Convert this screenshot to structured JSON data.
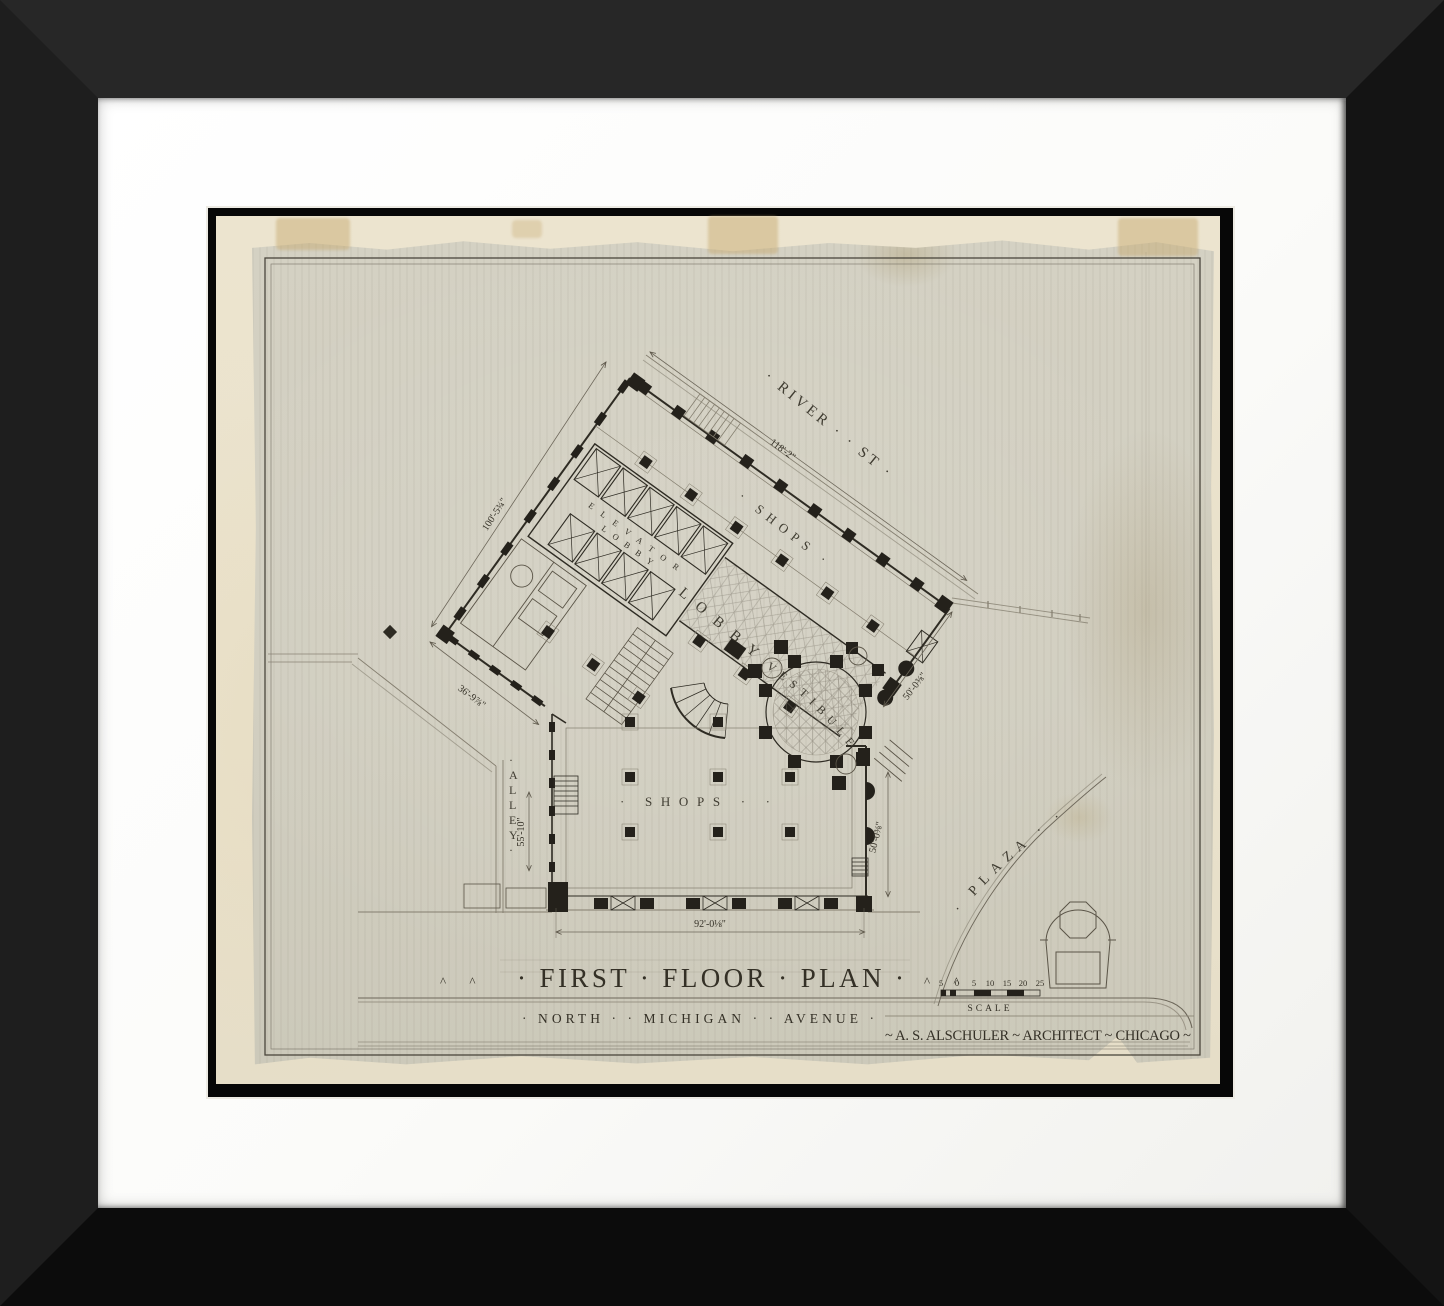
{
  "artwork": {
    "title": "· FIRST · FLOOR · PLAN ·",
    "title_marks_left": "^  ^",
    "title_marks_right": "^  ^",
    "avenue": "· NORTH ·   · MICHIGAN ·   · AVENUE ·",
    "credit": "~ A. S. ALSCHULER ~ ARCHITECT ~ CHICAGO ~",
    "scale": {
      "label": "SCALE",
      "ticks": [
        "5",
        "0",
        "5",
        "10",
        "15",
        "20",
        "25"
      ]
    }
  },
  "plan": {
    "streets": {
      "river_st": "· RIVER ·  · ST ·",
      "alley": "·ALLEY·",
      "plaza": "· PLAZA · ·"
    },
    "rooms": {
      "shops_upper": "· SHOPS ·",
      "shops_lower": "· SHOPS · ·",
      "elevator_line1": "ELEVATOR",
      "elevator_line2": "LOBBY",
      "lobby": "LOBBY",
      "vestibule": "VESTIBULE"
    },
    "dimensions": {
      "river_frontage": "118'-2\"",
      "northwest_wall": "100'-5¾\"",
      "southwest_wall": "36'-9⅞\"",
      "alley_side": "55'-10\"",
      "avenue_frontage": "92'-0⅛\"",
      "east_upper": "50'-0⅜\"",
      "east_lower": "50'-0⅜\""
    }
  },
  "colors": {
    "frame": "#1c1c1c",
    "mat": "#fbfbf9",
    "paper": "#ece4cf",
    "sheet": "#d2cfc1",
    "ink": "#2e2b23",
    "ink_light": "#847e6f"
  }
}
